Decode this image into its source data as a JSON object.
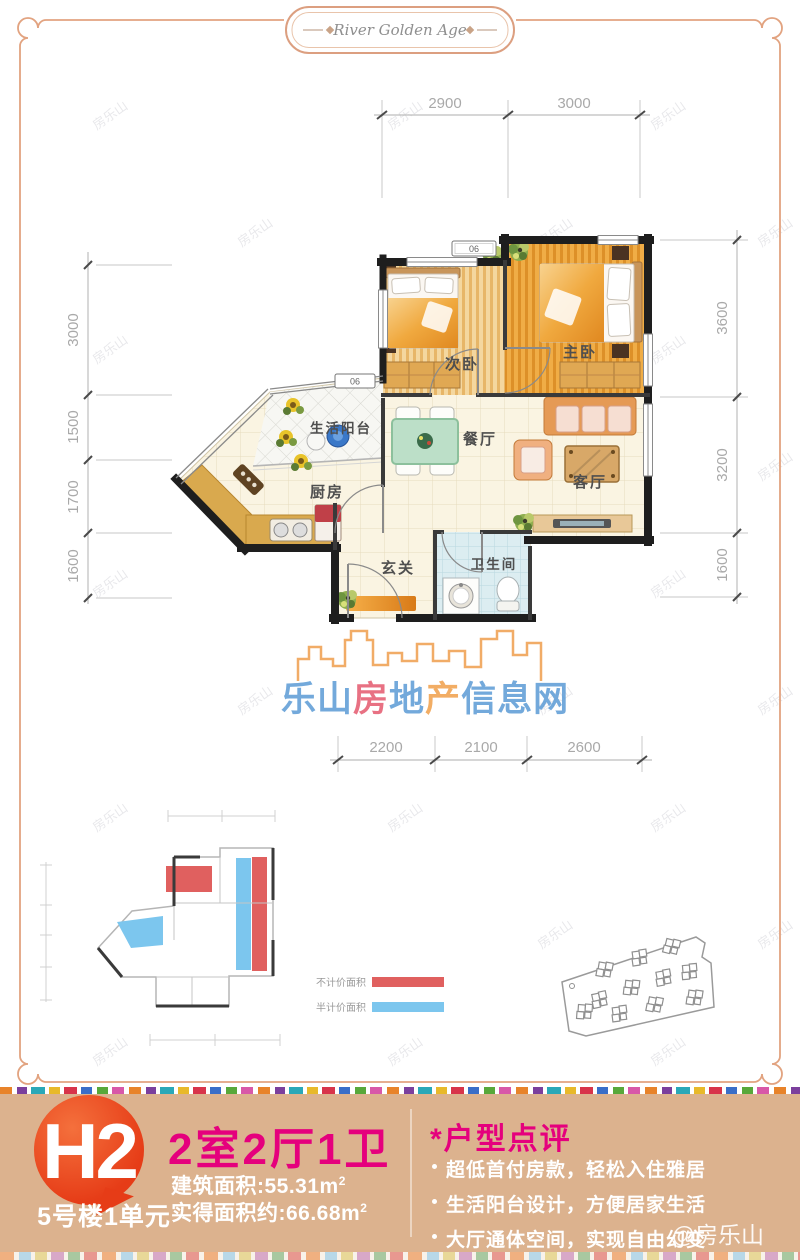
{
  "badge": {
    "text": "River Golden Age"
  },
  "watermark": {
    "text": "房乐山",
    "handle": "@房乐山"
  },
  "floorplan": {
    "rooms": [
      {
        "id": "bedroom2",
        "label": "次卧"
      },
      {
        "id": "master",
        "label": "主卧"
      },
      {
        "id": "dining",
        "label": "餐厅"
      },
      {
        "id": "living",
        "label": "客厅"
      },
      {
        "id": "kitchen",
        "label": "厨房"
      },
      {
        "id": "balcony",
        "label": "生活阳台"
      },
      {
        "id": "entry",
        "label": "玄关"
      },
      {
        "id": "bathroom",
        "label": "卫生间"
      }
    ],
    "unit_tags": [
      "06",
      "06"
    ],
    "dimensions": {
      "top": [
        "2900",
        "3000"
      ],
      "left": [
        "3000",
        "1500",
        "1700",
        "1600"
      ],
      "right": [
        "3600",
        "3200",
        "1600"
      ],
      "bottom": [
        "2200",
        "2100",
        "2600"
      ]
    }
  },
  "logo": {
    "parts": [
      {
        "text": "乐山",
        "color": "#5b9bd5"
      },
      {
        "text": "房",
        "color": "#e4596e"
      },
      {
        "text": "地",
        "color": "#5b9bd5"
      },
      {
        "text": "产",
        "color": "#f09f4a"
      },
      {
        "text": "信息网",
        "color": "#5b9bd5"
      }
    ]
  },
  "legend": {
    "items": [
      {
        "label": "不计价面积",
        "color": "#e0605f"
      },
      {
        "label": "半计价面积",
        "color": "#7cc6ee"
      }
    ]
  },
  "banner": {
    "plan_code": "H2",
    "building": "5号楼1单元",
    "layout": "2室2厅1卫",
    "area_built": {
      "text": "建筑面积:55.31m",
      "sup": "2"
    },
    "area_actual": {
      "text": "实得面积约:66.68m",
      "sup": "2"
    },
    "review_title": "*户型点评",
    "reviews": [
      "超低首付房款，轻松入住雅居",
      "生活阳台设计，方便居家生活",
      "大厅通体空间，实现自由幻变"
    ]
  },
  "colors": {
    "frame": "#e2a380",
    "accent_magenta": "#e5007d",
    "bubble_red": "#e63c17",
    "banner_tan": "#dcb28e",
    "wall_black": "#1e1e1e",
    "legend_red": "#e0605f",
    "legend_blue": "#7cc6ee"
  }
}
